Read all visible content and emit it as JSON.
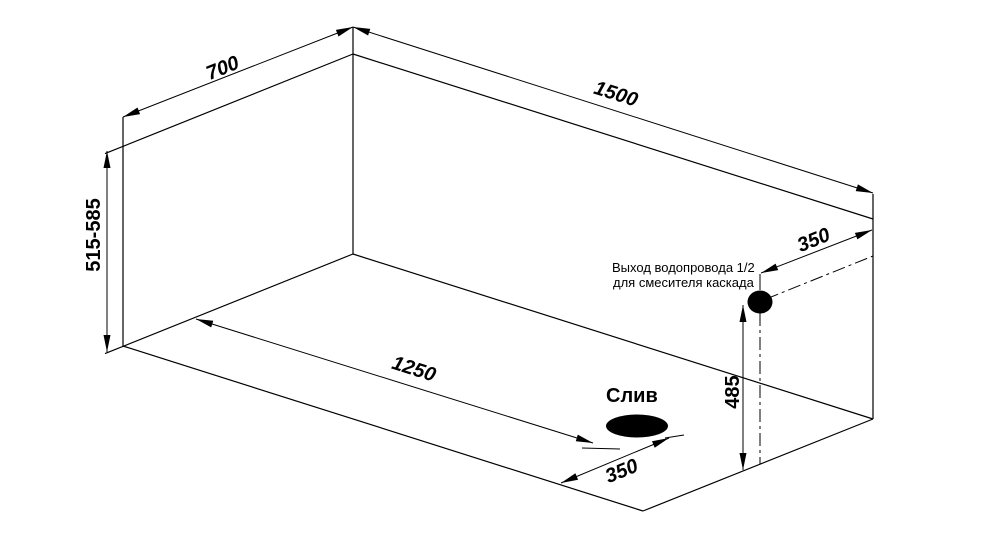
{
  "canvas": {
    "background": "#ffffff",
    "line_color": "#000000",
    "fill_color": "#000000"
  },
  "dimensions": {
    "top_width": "700",
    "top_length": "1500",
    "height_range": "515-585",
    "drain_from_left_wall": "1250",
    "drain_from_front_wall": "350",
    "outlet_height_from_bottom": "485",
    "outlet_from_right_edge": "350"
  },
  "labels": {
    "drain": "Слив",
    "outlet_note_line1": "Выход водопровода 1/2",
    "outlet_note_line2": "для смесителя каскада"
  }
}
